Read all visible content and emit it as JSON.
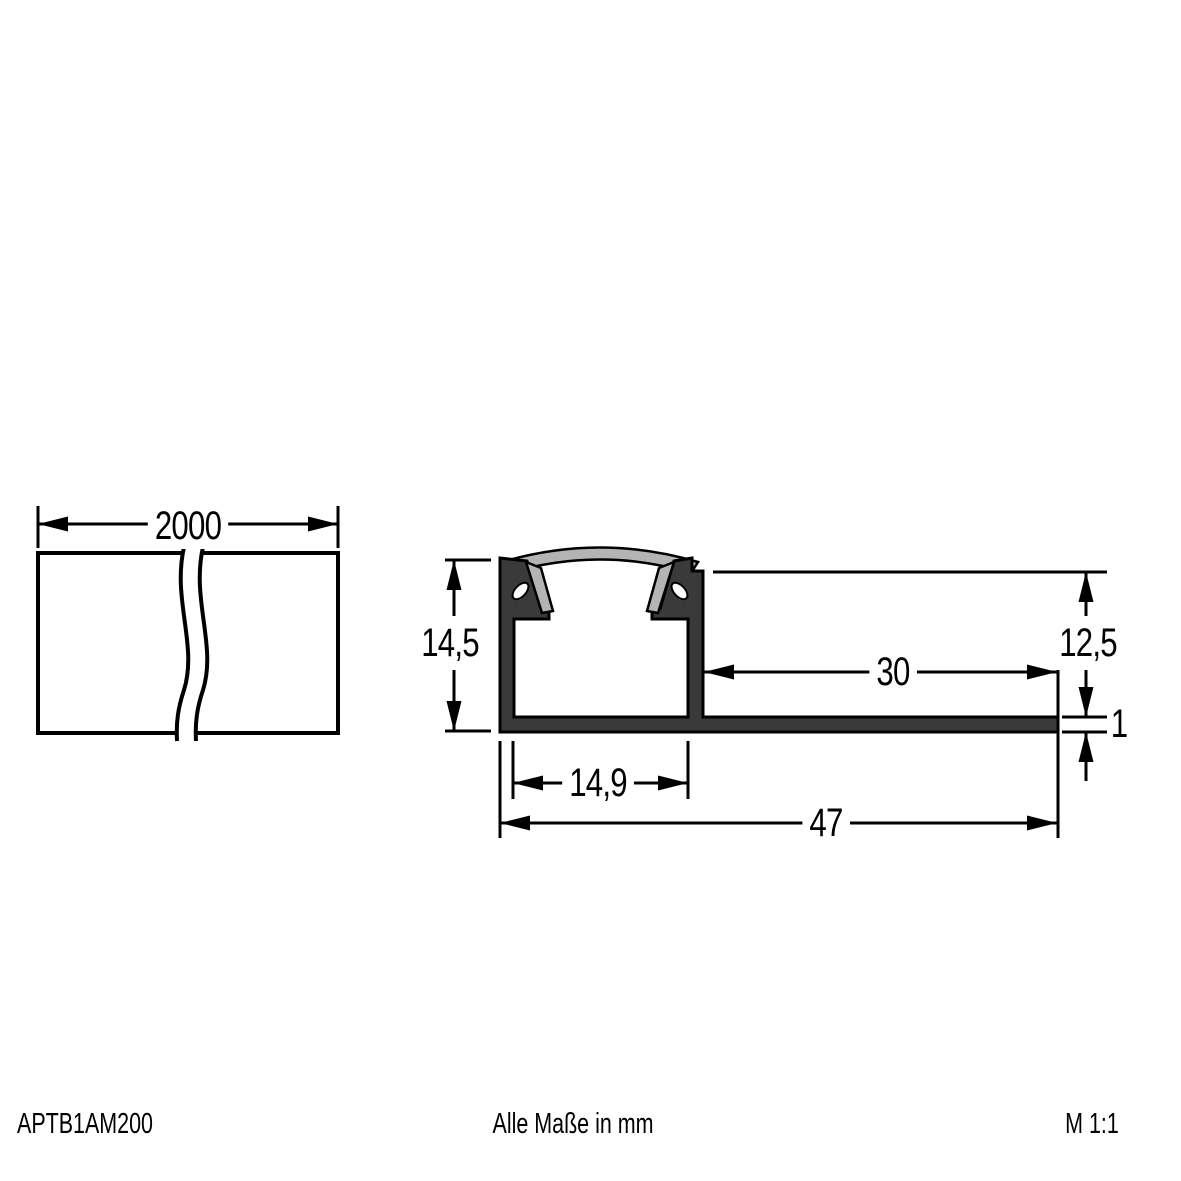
{
  "dimensions": {
    "profile_length": "2000",
    "total_height": "14,5",
    "tile_depth": "12,5",
    "flange_length": "30",
    "flange_thickness": "1",
    "inner_width": "14,9",
    "total_width": "47"
  },
  "footer": {
    "article_number": "APTB1AM200",
    "units_note": "Alle Maße in mm",
    "scale": "M 1:1"
  },
  "colors": {
    "line": "#000000",
    "profile_body": "#3a3a3a",
    "cover": "#b4b4b4",
    "background": "#ffffff"
  }
}
